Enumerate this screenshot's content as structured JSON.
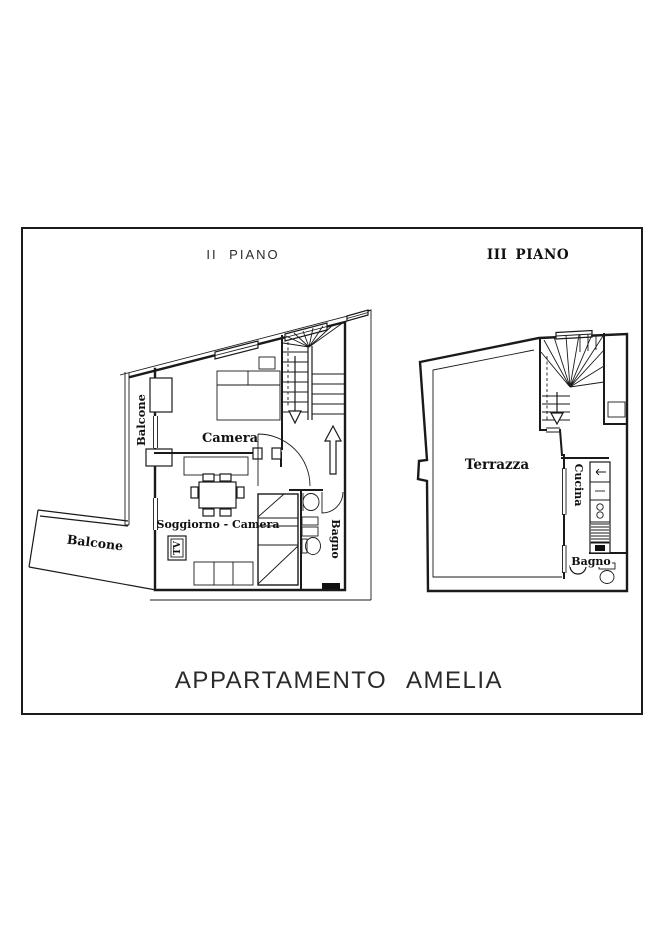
{
  "palette": {
    "line": "#1a1a1a",
    "background": "#ffffff",
    "border": "#1b1b1b"
  },
  "title": "APPARTAMENTO AMELIA",
  "floors": {
    "second": {
      "label": "II PIANO",
      "rooms": {
        "camera": "Camera",
        "soggiorno_camera": "Soggiorno - Camera",
        "bagno": "Bagno",
        "balcone_left": "Balcone",
        "balcone_bottom": "Balcone",
        "tv": "TV"
      }
    },
    "third": {
      "label": "III PIANO",
      "rooms": {
        "terrazza": "Terrazza",
        "cucina": "Cucina",
        "bagno": "Bagno"
      }
    }
  }
}
